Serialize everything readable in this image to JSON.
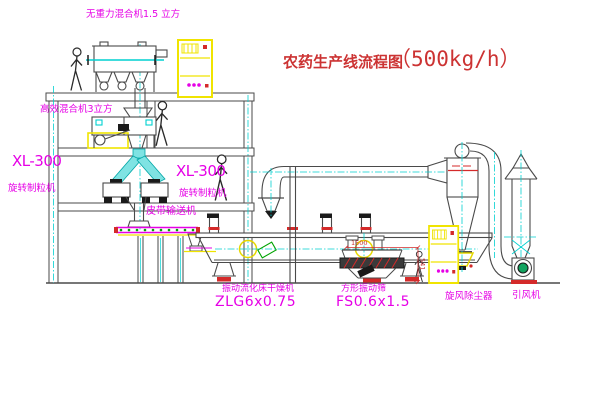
{
  "title": {
    "text": "农药生产线流程图",
    "capacity": "（500kg/h）"
  },
  "labels": {
    "gravity_mixer": "无重力混合机1.5 立方",
    "high_mixer": "高效混合机3立方",
    "xl300_left": "XL-300",
    "granulator_left": "旋转制粒机",
    "xl300_mid": "XL-300",
    "granulator_mid": "旋转制粒机",
    "belt_conveyor": "皮带输送机",
    "dryer": "振动流化床干燥机",
    "dryer_model": "ZLG6x0.75",
    "sieve": "方形振动筛",
    "sieve_model": "FS0.6x1.5",
    "cyclone": "旋风除尘器",
    "fan": "引风机",
    "dim_length": "1500",
    "dim_height": "541"
  },
  "colors": {
    "label_magenta": "#e600e6",
    "title_red": "#cc3333",
    "centerline_cyan": "#00d0d0",
    "cabinet_yellow": "#f0e400",
    "structure_gray": "#4a4a4a",
    "accent_red": "#d42a2a",
    "dot_green": "#00a300"
  }
}
